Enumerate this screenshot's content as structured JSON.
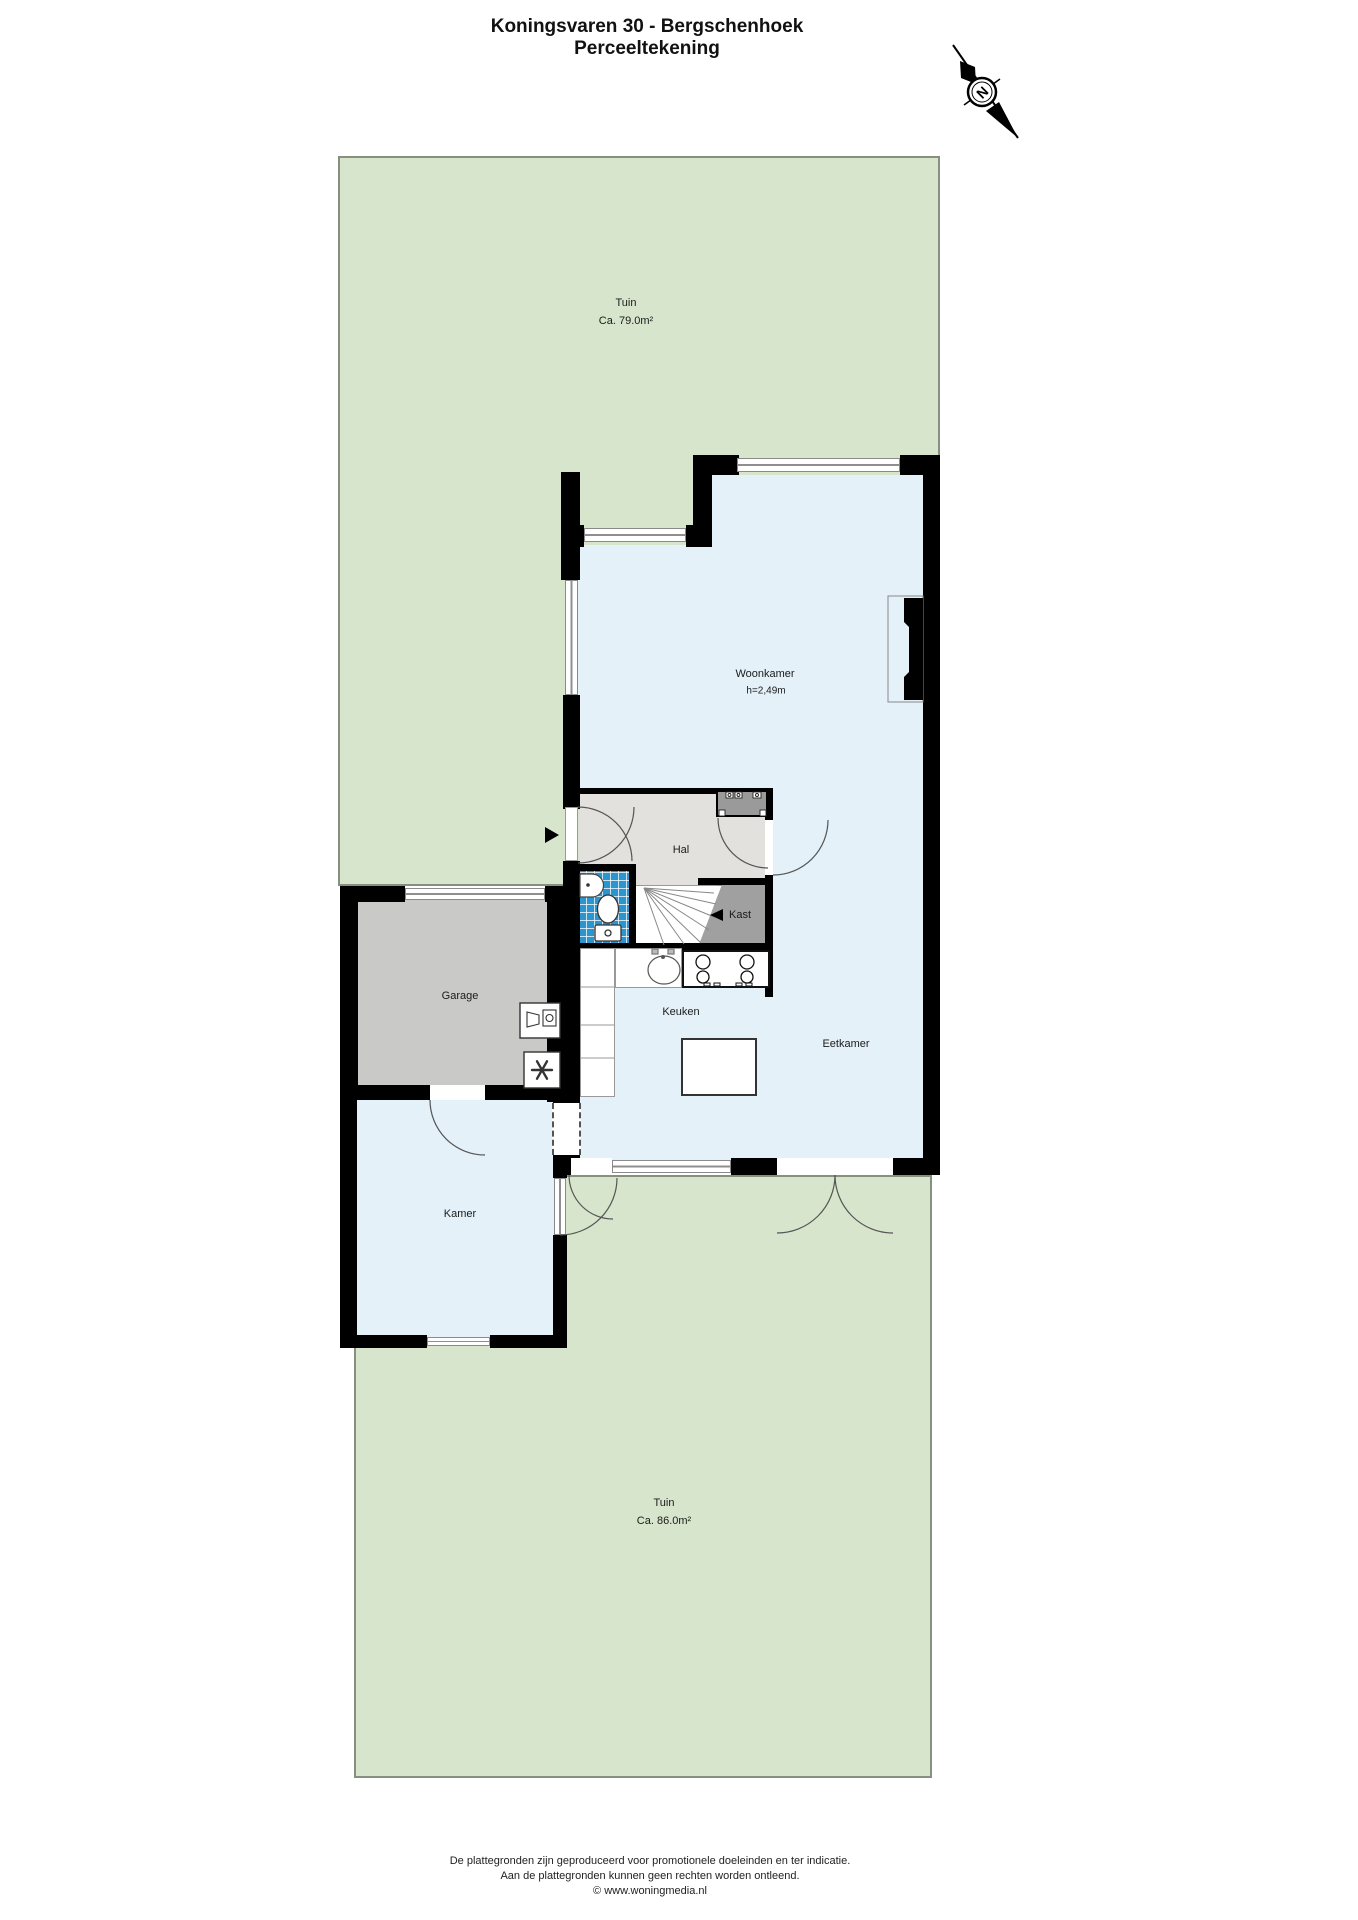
{
  "title": {
    "line1": "Koningsvaren 30 - Bergschenhoek",
    "line2": "Perceeltekening"
  },
  "compass": {
    "label": "N"
  },
  "rooms": {
    "tuin_top": {
      "name": "Tuin",
      "area": "Ca. 79.0m²"
    },
    "woonkamer": {
      "name": "Woonkamer",
      "ceiling_height": "h=2,49m"
    },
    "hal": {
      "name": "Hal"
    },
    "kast": {
      "name": "Kast"
    },
    "garage": {
      "name": "Garage"
    },
    "keuken": {
      "name": "Keuken"
    },
    "eetkamer": {
      "name": "Eetkamer"
    },
    "kamer": {
      "name": "Kamer"
    },
    "tuin_bottom": {
      "name": "Tuin",
      "area": "Ca. 86.0m²"
    }
  },
  "footer": {
    "line1": "De plattegronden zijn geproduceerd voor promotionele doeleinden en ter indicatie.",
    "line2": "Aan de plattegronden kunnen geen rechten worden ontleend.",
    "line3": "© www.woningmedia.nl"
  },
  "colors": {
    "garden": "#d7e5cc",
    "garden_border": "#87907e",
    "room": "#e4f1f8",
    "hall_floor": "#e2e1de",
    "garage_floor": "#c9c9c7",
    "closet": "#a0a0a0",
    "meter_closet": "#9a9a9a",
    "tile_blue": "#2d95cd",
    "wall": "#000000",
    "line": "#555555"
  }
}
